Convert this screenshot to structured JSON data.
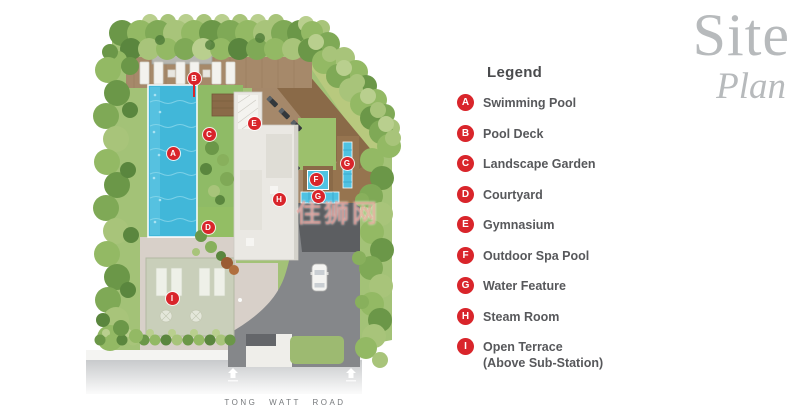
{
  "title": {
    "line1": "Site",
    "line2": "Plan"
  },
  "legend": {
    "heading": "Legend",
    "items": [
      {
        "letter": "A",
        "label": "Swimming Pool"
      },
      {
        "letter": "B",
        "label": "Pool Deck"
      },
      {
        "letter": "C",
        "label": "Landscape Garden"
      },
      {
        "letter": "D",
        "label": "Courtyard"
      },
      {
        "letter": "E",
        "label": "Gymnasium"
      },
      {
        "letter": "F",
        "label": "Outdoor Spa Pool"
      },
      {
        "letter": "G",
        "label": "Water Feature"
      },
      {
        "letter": "H",
        "label": "Steam Room"
      },
      {
        "letter": "I",
        "label": "Open Terrace",
        "label2": "(Above Sub-Station)"
      }
    ]
  },
  "plan": {
    "road_label": "TONG WATT ROAD",
    "watermark": "住狮网",
    "markers": [
      {
        "letter": "A",
        "x": 173,
        "y": 153
      },
      {
        "letter": "B",
        "x": 194,
        "y": 78,
        "stem": true
      },
      {
        "letter": "C",
        "x": 209,
        "y": 134
      },
      {
        "letter": "D",
        "x": 208,
        "y": 227
      },
      {
        "letter": "E",
        "x": 254,
        "y": 123
      },
      {
        "letter": "F",
        "x": 316,
        "y": 179
      },
      {
        "letter": "G",
        "x": 347,
        "y": 163
      },
      {
        "letter": "G",
        "x": 318,
        "y": 196
      },
      {
        "letter": "H",
        "x": 279,
        "y": 199
      },
      {
        "letter": "I",
        "x": 172,
        "y": 298
      }
    ]
  },
  "theme": {
    "marker_red": "#d9252b",
    "pool_blue": "#41b7d9",
    "deck_brown": "#a5886a",
    "tree_green": "#7fa956",
    "asphalt_gray": "#85878a",
    "title_gray": "#b7babc",
    "legend_text": "#57585b"
  }
}
